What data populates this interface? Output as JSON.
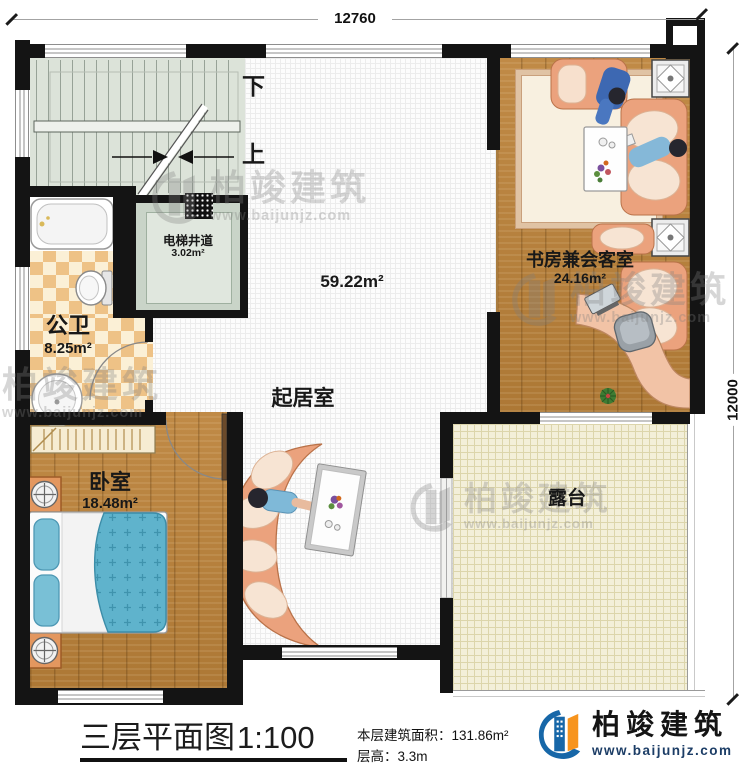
{
  "dims": {
    "top": "12760",
    "right": "12000"
  },
  "stairs": {
    "down": "下",
    "up": "上"
  },
  "rooms": {
    "elevator": {
      "name": "电梯井道",
      "area": "3.02m²"
    },
    "bathroom": {
      "name": "公卫",
      "area": "8.25m²"
    },
    "living": {
      "name": "起居室",
      "area": "59.22m²"
    },
    "study": {
      "name": "书房兼会客室",
      "area": "24.16m²"
    },
    "bedroom": {
      "name": "卧室",
      "area": "18.48m²"
    },
    "terrace": {
      "name": "露台"
    }
  },
  "footer": {
    "title": "三层平面图",
    "scale": "1:100",
    "area_label": "本层建筑面积：",
    "area_value": "131.86m²",
    "height_label": "层高：",
    "height_value": "3.3m"
  },
  "brand": {
    "name": "柏竣建筑",
    "website": "www.baijunjz.com"
  },
  "watermark": {
    "name": "柏竣建筑",
    "website": "www.baijunjz.com"
  },
  "colors": {
    "wall": "#141414",
    "wood": "#b9823f",
    "checker": "#eec286",
    "stair_floor": "#dce3d9",
    "terrace_floor": "#f3efd9",
    "bed_blue": "#5fb3cc",
    "sofa_peach": "#eba27d",
    "logo_blue": "#1767a8",
    "logo_orange": "#f7941d"
  }
}
